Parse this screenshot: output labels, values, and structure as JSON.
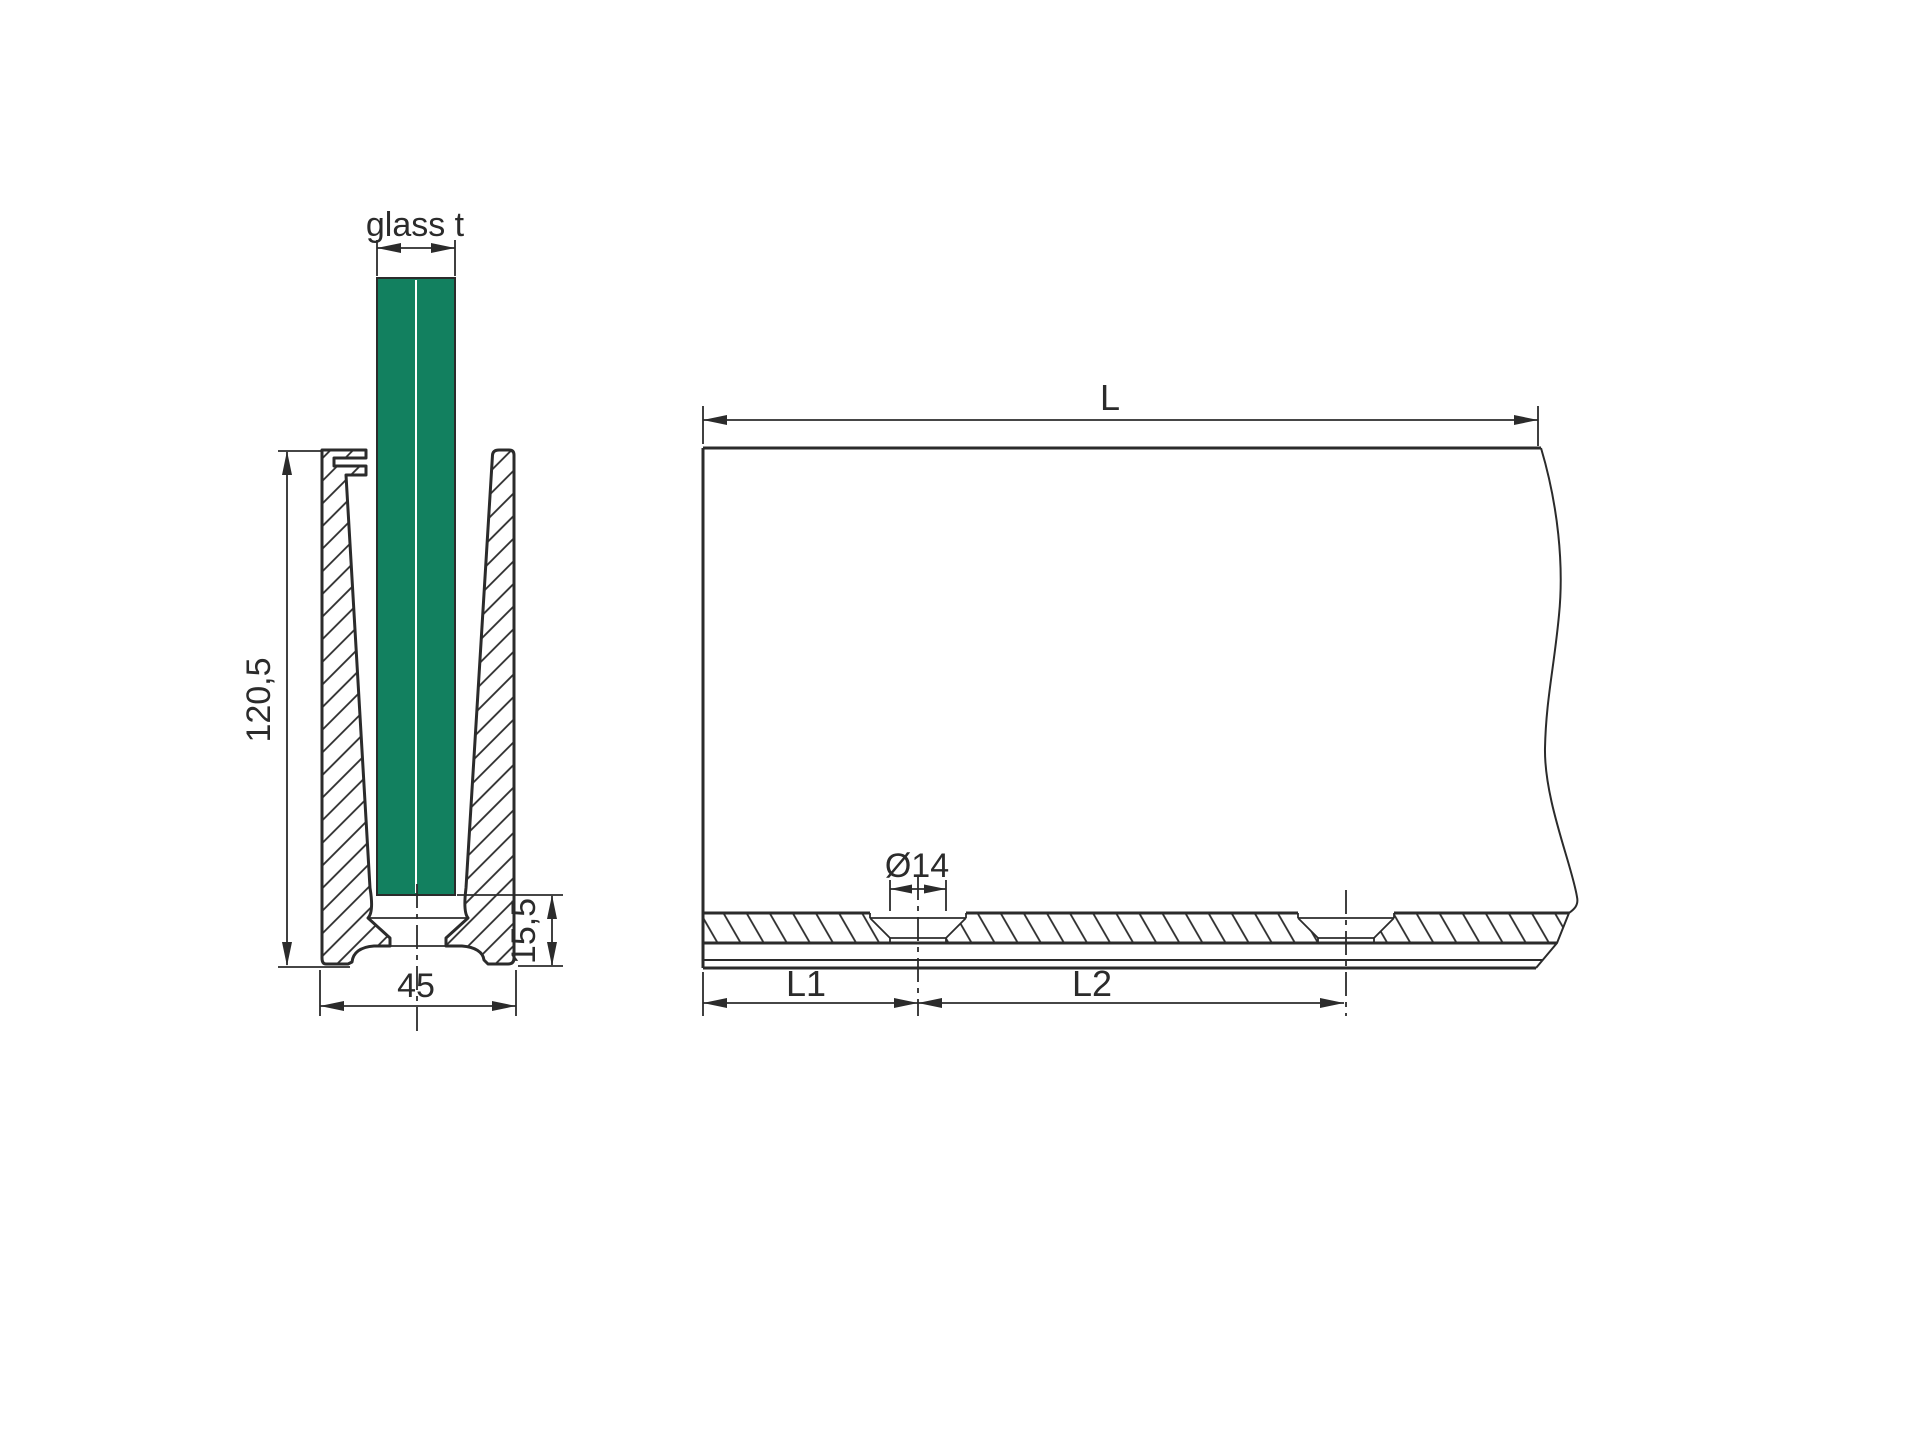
{
  "drawing": {
    "labels": {
      "glass_thickness": "glass t",
      "profile_height": "120,5",
      "profile_width": "45",
      "base_height": "15,5",
      "length": "L",
      "hole_diameter": "Ø14",
      "hole_offset": "L1",
      "hole_spacing": "L2"
    },
    "colors": {
      "line": "#2b2b2b",
      "glass": "#12805f",
      "background": "#ffffff"
    }
  }
}
